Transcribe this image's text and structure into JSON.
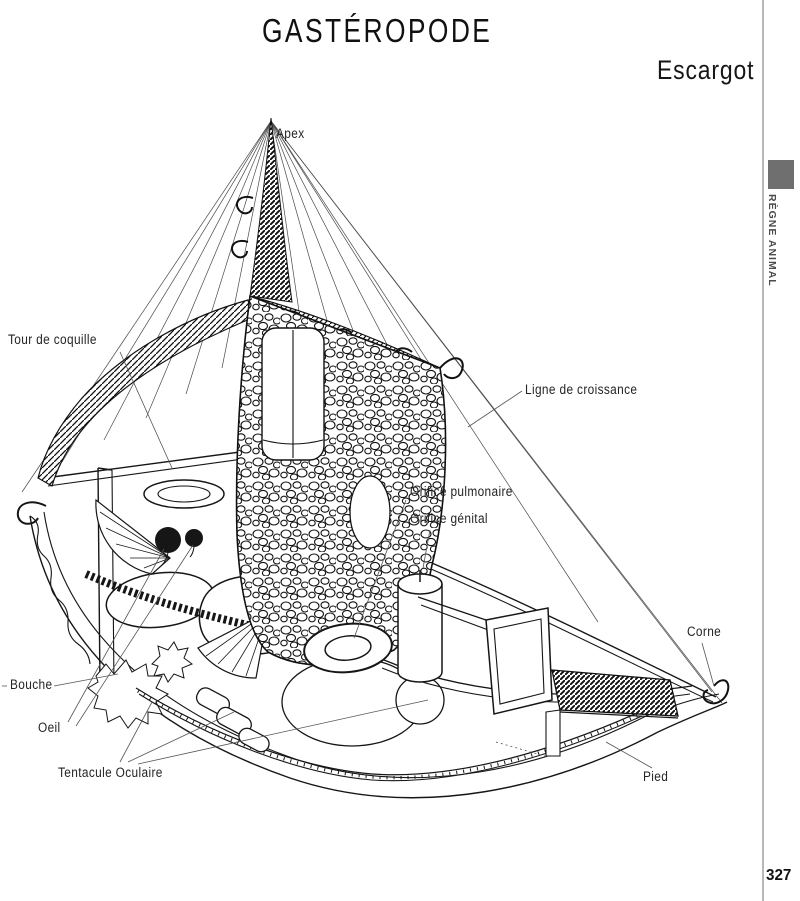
{
  "page": {
    "title": "GASTÉROPODE",
    "subtitle": "Escargot",
    "page_number": "327",
    "sidebar": {
      "category": "RÈGNE ANIMAL"
    }
  },
  "figure": {
    "subject": "escargot-cutaway-anatomy",
    "labels": [
      {
        "id": "apex",
        "text": "Apex"
      },
      {
        "id": "tour-de-coquille",
        "text": "Tour de coquille"
      },
      {
        "id": "ligne-de-croissance",
        "text": "Ligne de croissance"
      },
      {
        "id": "orifice-pulmonaire",
        "text": "Orifice pulmonaire"
      },
      {
        "id": "orifice-genital",
        "text": "Orifice génital"
      },
      {
        "id": "corne",
        "text": "Corne"
      },
      {
        "id": "bouche",
        "text": "Bouche"
      },
      {
        "id": "oeil",
        "text": "Oeil"
      },
      {
        "id": "tentacule-oculaire",
        "text": "Tentacule Oculaire"
      },
      {
        "id": "pied",
        "text": "Pied"
      }
    ]
  },
  "colors": {
    "ink": "#1a1a1a",
    "label_text": "#242424",
    "sidebar_rule": "#b8b8b8",
    "sidebar_tab": "#6f6f6f",
    "background": "#ffffff"
  }
}
